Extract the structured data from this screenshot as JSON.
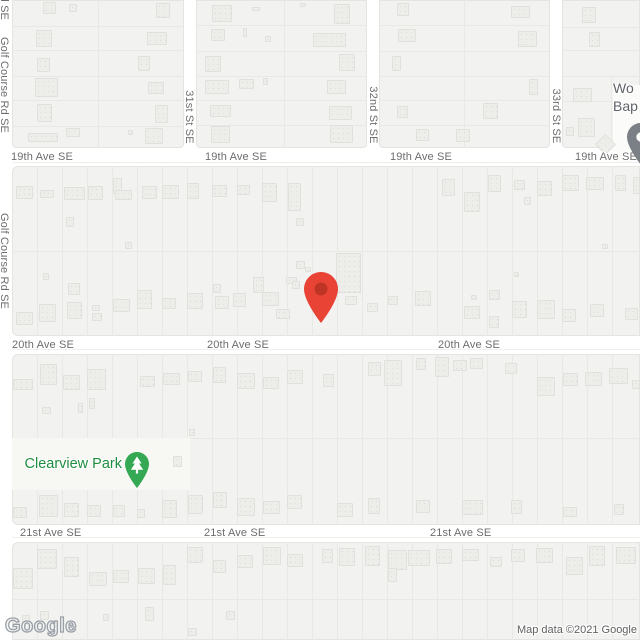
{
  "attribution": {
    "logo": "Google",
    "text": "Map data ©2021 Google"
  },
  "colors": {
    "road_color": "#FFFFFF",
    "block_color": "#F2F2F0",
    "block_border": "#E4E4E1",
    "lot_line": "#E8E8E5",
    "building_color": "#EDEDEA",
    "building_border": "#E0E0DC",
    "building_dot": "#DCDCD6",
    "park_color": "#F7F7F4",
    "street_label": "#6D6D6D",
    "park_label": "#1E8E3E",
    "park_pin": "#34A853",
    "poi_label": "#5F6368",
    "poi_pin": "#7B8086",
    "marker_red": "#E94335",
    "marker_red_inner": "#BE3526"
  },
  "streets": {
    "avenues": [
      {
        "name": "19th Ave SE",
        "label_y": 157,
        "label_xs": [
          11,
          205,
          390,
          575
        ]
      },
      {
        "name": "20th Ave SE",
        "label_y": 345,
        "label_xs": [
          12,
          207,
          438
        ]
      },
      {
        "name": "21st Ave SE",
        "label_y": 533,
        "label_xs": [
          20,
          204,
          430
        ]
      }
    ],
    "cross_streets": [
      {
        "name": "31st St SE",
        "x": 189,
        "label_y": 117
      },
      {
        "name": "32nd St SE",
        "x": 373,
        "label_y": 115
      },
      {
        "name": "33rd St SE",
        "x": 556,
        "label_y": 116
      }
    ],
    "left_road": {
      "name": "Golf Course Rd SE",
      "x": 4,
      "label_centers_y": [
        -28,
        85,
        261
      ]
    }
  },
  "marker": {
    "x": 321,
    "y": 289,
    "w": 34,
    "h": 51
  },
  "park": {
    "label": "Clearview Park",
    "label_x": 122,
    "label_y": 464,
    "pin_x": 137,
    "pin_y": 464
  },
  "church_poi": {
    "lines": [
      "Wo",
      "Bap"
    ],
    "x": 613,
    "y": 79,
    "pin_cx": 641,
    "pin_cy": 137
  },
  "geometry": {
    "blocks": [
      [
        12,
        0,
        172,
        148,
        "0 0 4px 4px"
      ],
      [
        196,
        0,
        171,
        148,
        "0 0 4px 4px"
      ],
      [
        379,
        0,
        171,
        148,
        "0 0 4px 4px"
      ],
      [
        562,
        0,
        78,
        148,
        "0 0 0 4px"
      ],
      [
        12,
        166,
        628,
        170,
        "6px 0 0 6px"
      ],
      [
        12,
        354,
        628,
        171,
        "6px 0 0 6px"
      ],
      [
        12,
        542,
        628,
        98,
        "6px 0 0 0"
      ]
    ],
    "road_center_lines": [
      {
        "y": 162,
        "x0": 12,
        "x1": 640
      },
      {
        "y": 349,
        "x0": 12,
        "x1": 640
      },
      {
        "y": 537,
        "x0": 12,
        "x1": 640
      }
    ],
    "lot_lines_v": [
      {
        "xs": [
          98
        ],
        "y0": 0,
        "y1": 148
      },
      {
        "xs": [
          284
        ],
        "y0": 0,
        "y1": 148
      },
      {
        "xs": [
          464
        ],
        "y0": 0,
        "y1": 148
      },
      {
        "xs": [
          611
        ],
        "y0": 76,
        "y1": 148
      },
      {
        "xs": [
          37,
          62,
          87,
          112,
          137,
          162,
          187,
          212,
          237,
          262,
          287,
          312,
          337,
          362,
          387,
          412,
          437,
          462,
          487,
          512,
          537,
          562,
          587,
          612
        ],
        "y0": 166,
        "y1": 336
      },
      {
        "xs": [
          37,
          62,
          87,
          112,
          137,
          162,
          187,
          212,
          237,
          262,
          287,
          312,
          337,
          362,
          387,
          412,
          437,
          462,
          487,
          512,
          537,
          562,
          587,
          612
        ],
        "y0": 354,
        "y1": 525
      },
      {
        "xs": [
          37,
          62,
          87,
          112,
          137,
          162,
          187,
          212,
          237,
          262,
          287,
          312,
          337,
          362,
          387,
          412,
          437,
          462,
          487,
          512,
          537,
          562,
          587,
          612
        ],
        "y0": 542,
        "y1": 640
      }
    ],
    "lot_lines_h": [
      {
        "ys": [
          26,
          50,
          76,
          100,
          126
        ],
        "x0": 12,
        "x1": 184
      },
      {
        "ys": [
          25,
          51,
          76,
          100,
          125
        ],
        "x0": 196,
        "x1": 367
      },
      {
        "ys": [
          25,
          51,
          76,
          100,
          125
        ],
        "x0": 379,
        "x1": 550
      },
      {
        "ys": [
          27,
          50,
          76,
          101
        ],
        "x0": 562,
        "x1": 640
      },
      {
        "ys": [
          251
        ],
        "x0": 12,
        "x1": 640
      },
      {
        "ys": [
          438
        ],
        "x0": 12,
        "x1": 640
      },
      {
        "ys": [
          599
        ],
        "x0": 12,
        "x1": 640
      }
    ],
    "park_area": [
      12,
      438,
      178,
      52
    ],
    "church_plot": [
      613,
      85,
      27,
      78
    ],
    "diamond_building": [
      598,
      137,
      15,
      15
    ],
    "buildings": [
      [
        43,
        2,
        13,
        12
      ],
      [
        69,
        4,
        8,
        8
      ],
      [
        156,
        3,
        14,
        15
      ],
      [
        36,
        30,
        16,
        17
      ],
      [
        147,
        32,
        20,
        13
      ],
      [
        37,
        58,
        13,
        14
      ],
      [
        138,
        56,
        12,
        15
      ],
      [
        35,
        78,
        23,
        19
      ],
      [
        148,
        82,
        16,
        12
      ],
      [
        37,
        104,
        15,
        18
      ],
      [
        155,
        105,
        13,
        18
      ],
      [
        28,
        133,
        30,
        9
      ],
      [
        66,
        128,
        14,
        9
      ],
      [
        128,
        130,
        5,
        5
      ],
      [
        145,
        128,
        18,
        16
      ],
      [
        212,
        5,
        20,
        17
      ],
      [
        252,
        7,
        8,
        4
      ],
      [
        300,
        3,
        6,
        4
      ],
      [
        334,
        4,
        16,
        20
      ],
      [
        211,
        29,
        14,
        12
      ],
      [
        243,
        28,
        4,
        9
      ],
      [
        265,
        36,
        6,
        6
      ],
      [
        313,
        33,
        33,
        14
      ],
      [
        205,
        56,
        16,
        16
      ],
      [
        339,
        54,
        16,
        17
      ],
      [
        205,
        80,
        24,
        14
      ],
      [
        239,
        79,
        15,
        10
      ],
      [
        263,
        78,
        5,
        7
      ],
      [
        327,
        80,
        19,
        14
      ],
      [
        210,
        105,
        21,
        12
      ],
      [
        329,
        106,
        23,
        14
      ],
      [
        211,
        126,
        19,
        17
      ],
      [
        330,
        125,
        23,
        18
      ],
      [
        397,
        3,
        12,
        13
      ],
      [
        398,
        29,
        18,
        13
      ],
      [
        392,
        56,
        9,
        15
      ],
      [
        397,
        106,
        11,
        12
      ],
      [
        416,
        129,
        13,
        12
      ],
      [
        511,
        6,
        19,
        12
      ],
      [
        518,
        31,
        19,
        16
      ],
      [
        529,
        79,
        9,
        16
      ],
      [
        483,
        103,
        15,
        16
      ],
      [
        456,
        129,
        14,
        13
      ],
      [
        582,
        7,
        14,
        16
      ],
      [
        589,
        32,
        11,
        15
      ],
      [
        573,
        88,
        19,
        14
      ],
      [
        578,
        118,
        17,
        19
      ],
      [
        566,
        127,
        8,
        9
      ],
      [
        16,
        186,
        17,
        13
      ],
      [
        40,
        190,
        14,
        8
      ],
      [
        64,
        187,
        21,
        13
      ],
      [
        88,
        186,
        15,
        14
      ],
      [
        113,
        178,
        9,
        16
      ],
      [
        115,
        190,
        17,
        10
      ],
      [
        142,
        186,
        15,
        13
      ],
      [
        162,
        185,
        17,
        14
      ],
      [
        187,
        183,
        12,
        16
      ],
      [
        212,
        185,
        15,
        12
      ],
      [
        237,
        185,
        13,
        10
      ],
      [
        262,
        183,
        15,
        19
      ],
      [
        288,
        183,
        13,
        28
      ],
      [
        442,
        179,
        13,
        17
      ],
      [
        464,
        192,
        16,
        20
      ],
      [
        488,
        175,
        13,
        17
      ],
      [
        514,
        180,
        11,
        10
      ],
      [
        524,
        197,
        7,
        8
      ],
      [
        537,
        181,
        15,
        15
      ],
      [
        562,
        175,
        17,
        16
      ],
      [
        586,
        177,
        18,
        13
      ],
      [
        615,
        175,
        11,
        16
      ],
      [
        633,
        177,
        7,
        17
      ],
      [
        296,
        261,
        9,
        8
      ],
      [
        305,
        267,
        6,
        5
      ],
      [
        336,
        253,
        25,
        40
      ],
      [
        66,
        217,
        8,
        10
      ],
      [
        125,
        242,
        7,
        7
      ],
      [
        296,
        218,
        8,
        8
      ],
      [
        602,
        244,
        6,
        5
      ],
      [
        514,
        272,
        5,
        5
      ],
      [
        43,
        273,
        6,
        7
      ],
      [
        16,
        312,
        17,
        13
      ],
      [
        39,
        304,
        17,
        18
      ],
      [
        68,
        283,
        12,
        12
      ],
      [
        67,
        302,
        15,
        17
      ],
      [
        92,
        305,
        8,
        6
      ],
      [
        92,
        313,
        10,
        8
      ],
      [
        113,
        299,
        17,
        13
      ],
      [
        137,
        290,
        15,
        19
      ],
      [
        162,
        298,
        14,
        11
      ],
      [
        187,
        293,
        16,
        16
      ],
      [
        213,
        284,
        8,
        9
      ],
      [
        215,
        296,
        14,
        13
      ],
      [
        233,
        293,
        13,
        14
      ],
      [
        262,
        292,
        17,
        14
      ],
      [
        286,
        277,
        11,
        7
      ],
      [
        292,
        281,
        8,
        8
      ],
      [
        253,
        277,
        11,
        16
      ],
      [
        276,
        309,
        14,
        10
      ],
      [
        345,
        296,
        12,
        9
      ],
      [
        367,
        303,
        11,
        9
      ],
      [
        388,
        296,
        10,
        9
      ],
      [
        415,
        291,
        16,
        15
      ],
      [
        489,
        290,
        11,
        10
      ],
      [
        464,
        306,
        16,
        13
      ],
      [
        471,
        295,
        6,
        5
      ],
      [
        489,
        316,
        10,
        12
      ],
      [
        512,
        301,
        15,
        17
      ],
      [
        537,
        300,
        18,
        19
      ],
      [
        562,
        309,
        14,
        13
      ],
      [
        590,
        304,
        14,
        13
      ],
      [
        625,
        308,
        13,
        12
      ],
      [
        13,
        379,
        20,
        11
      ],
      [
        40,
        364,
        17,
        21
      ],
      [
        63,
        375,
        17,
        15
      ],
      [
        87,
        369,
        19,
        21
      ],
      [
        140,
        376,
        15,
        11
      ],
      [
        163,
        373,
        17,
        12
      ],
      [
        188,
        371,
        14,
        11
      ],
      [
        213,
        367,
        13,
        16
      ],
      [
        237,
        373,
        18,
        16
      ],
      [
        263,
        377,
        16,
        12
      ],
      [
        287,
        370,
        16,
        14
      ],
      [
        323,
        374,
        11,
        13
      ],
      [
        368,
        362,
        13,
        14
      ],
      [
        384,
        360,
        18,
        26
      ],
      [
        416,
        358,
        10,
        12
      ],
      [
        435,
        357,
        14,
        20
      ],
      [
        453,
        360,
        14,
        11
      ],
      [
        470,
        358,
        13,
        11
      ],
      [
        505,
        363,
        12,
        11
      ],
      [
        537,
        377,
        18,
        19
      ],
      [
        563,
        373,
        15,
        13
      ],
      [
        585,
        372,
        17,
        14
      ],
      [
        609,
        368,
        19,
        16
      ],
      [
        632,
        380,
        8,
        9
      ],
      [
        42,
        407,
        9,
        7
      ],
      [
        78,
        403,
        5,
        10
      ],
      [
        89,
        398,
        6,
        11
      ],
      [
        173,
        456,
        9,
        11
      ],
      [
        189,
        429,
        6,
        7
      ],
      [
        13,
        507,
        14,
        11
      ],
      [
        39,
        495,
        19,
        22
      ],
      [
        64,
        503,
        15,
        14
      ],
      [
        87,
        505,
        14,
        12
      ],
      [
        113,
        505,
        12,
        12
      ],
      [
        137,
        509,
        8,
        9
      ],
      [
        162,
        500,
        15,
        18
      ],
      [
        188,
        495,
        15,
        19
      ],
      [
        213,
        492,
        14,
        16
      ],
      [
        237,
        498,
        18,
        18
      ],
      [
        263,
        501,
        17,
        13
      ],
      [
        287,
        495,
        15,
        14
      ],
      [
        337,
        503,
        16,
        14
      ],
      [
        368,
        498,
        12,
        16
      ],
      [
        416,
        500,
        14,
        13
      ],
      [
        462,
        500,
        21,
        15
      ],
      [
        511,
        500,
        11,
        14
      ],
      [
        563,
        507,
        14,
        10
      ],
      [
        614,
        504,
        10,
        11
      ],
      [
        13,
        568,
        20,
        21
      ],
      [
        37,
        549,
        20,
        20
      ],
      [
        64,
        557,
        15,
        20
      ],
      [
        89,
        572,
        18,
        14
      ],
      [
        113,
        570,
        16,
        13
      ],
      [
        138,
        568,
        17,
        16
      ],
      [
        163,
        565,
        13,
        20
      ],
      [
        187,
        547,
        16,
        16
      ],
      [
        213,
        560,
        13,
        13
      ],
      [
        237,
        555,
        16,
        13
      ],
      [
        263,
        547,
        18,
        18
      ],
      [
        287,
        554,
        16,
        13
      ],
      [
        322,
        549,
        11,
        14
      ],
      [
        339,
        548,
        16,
        18
      ],
      [
        365,
        546,
        15,
        20
      ],
      [
        388,
        550,
        19,
        20
      ],
      [
        388,
        568,
        9,
        14
      ],
      [
        408,
        550,
        22,
        16
      ],
      [
        436,
        549,
        16,
        15
      ],
      [
        462,
        549,
        17,
        12
      ],
      [
        490,
        557,
        12,
        10
      ],
      [
        511,
        549,
        14,
        13
      ],
      [
        536,
        548,
        17,
        15
      ],
      [
        566,
        557,
        17,
        18
      ],
      [
        589,
        546,
        16,
        20
      ],
      [
        616,
        547,
        20,
        17
      ],
      [
        22,
        615,
        8,
        7
      ],
      [
        40,
        611,
        9,
        9
      ],
      [
        103,
        614,
        6,
        7
      ],
      [
        145,
        607,
        9,
        14
      ],
      [
        226,
        611,
        9,
        9
      ],
      [
        188,
        628,
        9,
        8
      ]
    ]
  }
}
